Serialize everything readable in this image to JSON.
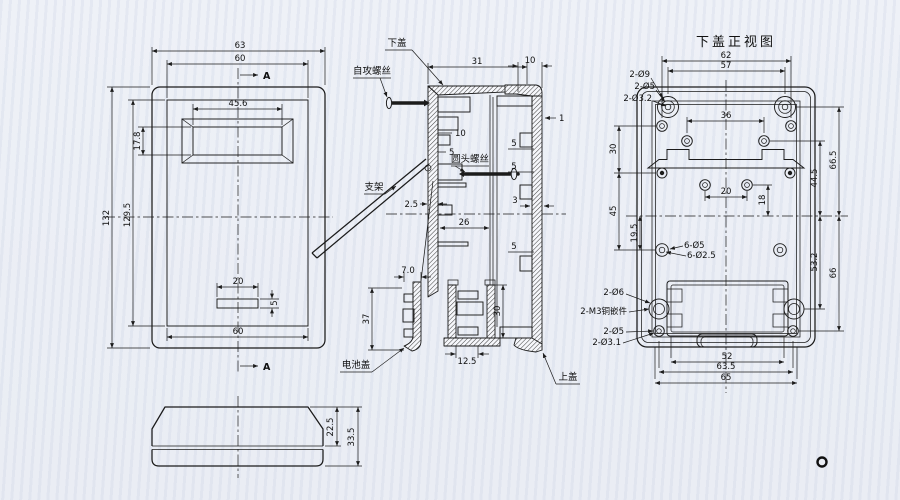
{
  "colors": {
    "paper": "#edf0f6",
    "ink": "#1b1b1b"
  },
  "front": {
    "dim_width_outer": "63",
    "dim_width_inner": "60",
    "dim_window_width": "45.6",
    "dim_window_height": "17.8",
    "dim_height_outer": "132",
    "dim_height_inner": "129.5",
    "dim_slot_width": "20",
    "dim_slot_height": "5",
    "dim_width_bottom": "60",
    "section_marker_top": "A",
    "section_marker_bottom": "A"
  },
  "side": {
    "dim_upper_height": "22.5",
    "dim_total_height": "33.5"
  },
  "section": {
    "label_bottom_cover": "下盖",
    "dim_top_width": "31",
    "label_self_tapping_screw": "自攻螺丝",
    "dim_boss": "10",
    "dim_rib": "5",
    "label_round_head_screw": "圆头螺丝",
    "label_bracket": "支架",
    "dim_wall_thickness": "2.5",
    "dim_inner_depth": "26",
    "dim_battery_cover_width": "7.0",
    "dim_battery_cover_height": "37",
    "dim_battery_box_height": "30",
    "dim_battery_box_width": "12.5",
    "label_battery_cover": "电池盖",
    "label_top_cover": "上盖",
    "dim_top_cover_width": "10",
    "dim_top_cover_wall": "1",
    "dim_rib_a": "5",
    "dim_rib_b": "5",
    "dim_center_wall": "3",
    "dim_rib_c": "5"
  },
  "bottom": {
    "title": "下盖正视图",
    "dim_62": "62",
    "dim_57": "57",
    "label_hole_2d9": "2-Ø9",
    "label_hole_2d5": "2-Ø5",
    "label_hole_2d32": "2-Ø3.2",
    "dim_36": "36",
    "dim_30": "30",
    "dim_45": "45",
    "dim_19_5": "19.5",
    "dim_20": "20",
    "dim_18": "18",
    "dim_66_5": "66.5",
    "dim_44_5": "44.5",
    "dim_53_2": "53.2",
    "dim_66": "66",
    "label_hole_6d5": "6-Ø5",
    "label_hole_6d25": "6-Ø2.5",
    "label_hole_2d6": "2-Ø6",
    "label_insert_2m3": "2-M3铜嵌件",
    "label_hole_2d5b": "2-Ø5",
    "label_hole_2d31": "2-Ø3.1",
    "dim_52": "52",
    "dim_63_5": "63.5",
    "dim_65": "65"
  }
}
